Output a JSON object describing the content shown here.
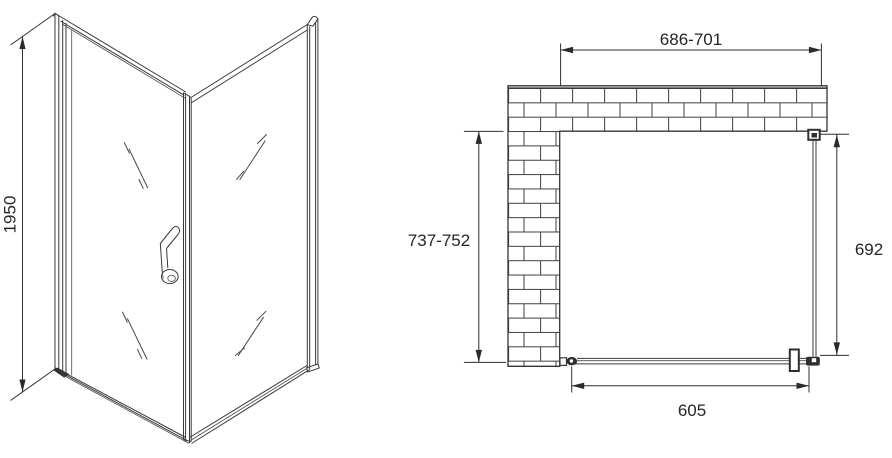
{
  "front_view": {
    "height_label": "1950"
  },
  "plan_view": {
    "opening_width_label": "686-701",
    "depth_label": "737-752",
    "side_panel_label": "692",
    "door_width_label": "605"
  },
  "colors": {
    "background": "#ffffff",
    "line": "#3a3a3a",
    "text": "#262626",
    "fill_dark": "#2e2e2e"
  }
}
